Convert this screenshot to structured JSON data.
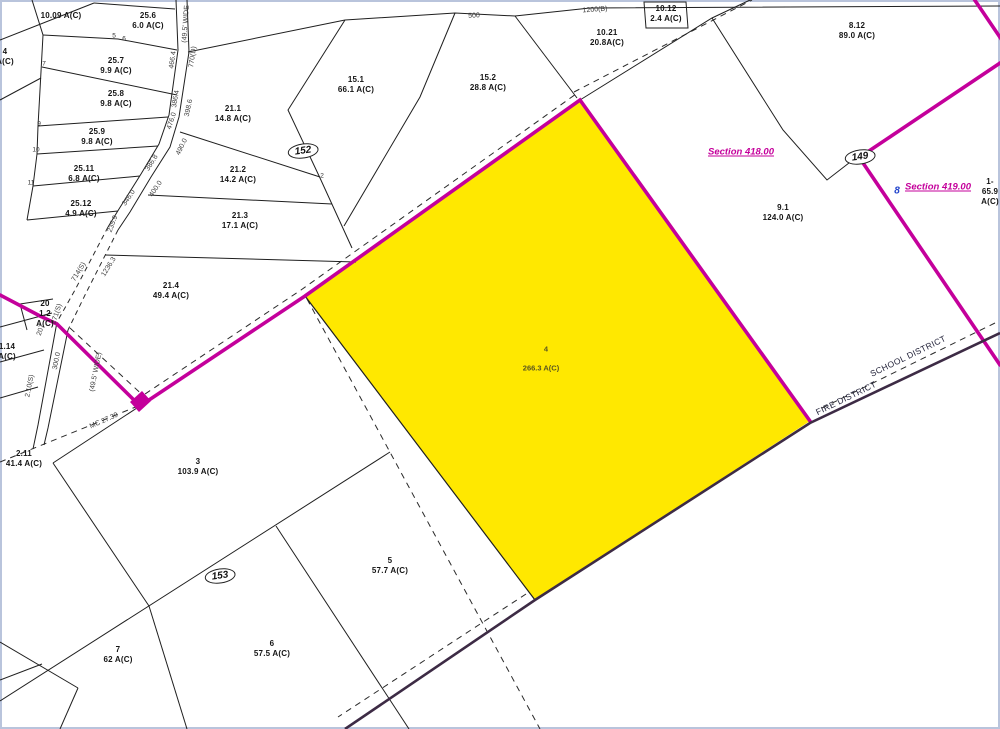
{
  "colors": {
    "highlight_fill": "#FFE800",
    "magenta": "#C4009B",
    "district_line": "#3D2B45",
    "section_text": "#CC0099",
    "blue_marker": "#2244CC",
    "frame_border": "#B9C4DC"
  },
  "highlight": {
    "num": "4",
    "area": "266.3 A(C)"
  },
  "parcels": [
    {
      "num": "",
      "area": "10.09 A(C)",
      "x": 61,
      "y": 16
    },
    {
      "num": "25.6",
      "area": "6.0 A(C)",
      "x": 148,
      "y": 21
    },
    {
      "num": "25.7",
      "area": "9.9 A(C)",
      "x": 116,
      "y": 66
    },
    {
      "num": "25.8",
      "area": "9.8 A(C)",
      "x": 116,
      "y": 99
    },
    {
      "num": "25.9",
      "area": "9.8 A(C)",
      "x": 97,
      "y": 137
    },
    {
      "num": "25.11",
      "area": "6.8 A(C)",
      "x": 84,
      "y": 174
    },
    {
      "num": "25.12",
      "area": "4.9 A(C)",
      "x": 81,
      "y": 209
    },
    {
      "num": "21.1",
      "area": "14.8 A(C)",
      "x": 233,
      "y": 114
    },
    {
      "num": "21.2",
      "area": "14.2 A(C)",
      "x": 238,
      "y": 175
    },
    {
      "num": "21.3",
      "area": "17.1 A(C)",
      "x": 240,
      "y": 221
    },
    {
      "num": "21.4",
      "area": "49.4 A(C)",
      "x": 171,
      "y": 291
    },
    {
      "num": "20",
      "area": "1.2\nA(C)",
      "x": 45,
      "y": 314
    },
    {
      "num": "1.14",
      "area": "A(C)",
      "x": 7,
      "y": 352
    },
    {
      "num": "4",
      "area": "A(C)",
      "x": 5,
      "y": 57
    },
    {
      "num": "2.11",
      "area": "41.4 A(C)",
      "x": 24,
      "y": 459
    },
    {
      "num": "15.1",
      "area": "66.1 A(C)",
      "x": 356,
      "y": 85
    },
    {
      "num": "15.2",
      "area": "28.8 A(C)",
      "x": 488,
      "y": 83
    },
    {
      "num": "10.21",
      "area": "20.8A(C)",
      "x": 607,
      "y": 38
    },
    {
      "num": "10.12",
      "area": "2.4 A(C)",
      "x": 666,
      "y": 14
    },
    {
      "num": "8.12",
      "area": "89.0 A(C)",
      "x": 857,
      "y": 31
    },
    {
      "num": "9.1",
      "area": "124.0 A(C)",
      "x": 783,
      "y": 213
    },
    {
      "num": "3",
      "area": "103.9 A(C)",
      "x": 198,
      "y": 467
    },
    {
      "num": "5",
      "area": "57.7 A(C)",
      "x": 390,
      "y": 566
    },
    {
      "num": "6",
      "area": "57.5 A(C)",
      "x": 272,
      "y": 649
    },
    {
      "num": "7",
      "area": "62 A(C)",
      "x": 118,
      "y": 655
    },
    {
      "num": "1-",
      "area": "65.9 A(C)",
      "x": 990,
      "y": 192
    }
  ],
  "tiny_numbers": [
    {
      "t": "5",
      "x": 114,
      "y": 36
    },
    {
      "t": "6",
      "x": 124,
      "y": 39
    },
    {
      "t": "7",
      "x": 44,
      "y": 64
    },
    {
      "t": "9",
      "x": 39,
      "y": 124
    },
    {
      "t": "10",
      "x": 36,
      "y": 150
    },
    {
      "t": "11",
      "x": 31,
      "y": 183
    },
    {
      "t": "2",
      "x": 322,
      "y": 176
    }
  ],
  "dims": [
    {
      "t": "(49.5' WIDE",
      "x": 186,
      "y": 24,
      "r": -86
    },
    {
      "t": "466.4",
      "x": 173,
      "y": 60,
      "r": -82
    },
    {
      "t": "770(D)",
      "x": 193,
      "y": 57,
      "r": -82
    },
    {
      "t": "386.4",
      "x": 176,
      "y": 99,
      "r": -80
    },
    {
      "t": "398.6",
      "x": 189,
      "y": 108,
      "r": -78
    },
    {
      "t": "476.0",
      "x": 172,
      "y": 121,
      "r": -72
    },
    {
      "t": "490.0",
      "x": 182,
      "y": 147,
      "r": -64
    },
    {
      "t": "386.8",
      "x": 152,
      "y": 163,
      "r": -58
    },
    {
      "t": "400.0",
      "x": 156,
      "y": 189,
      "r": -56
    },
    {
      "t": "346.0",
      "x": 129,
      "y": 198,
      "r": -56
    },
    {
      "t": "235.9",
      "x": 113,
      "y": 224,
      "r": -70
    },
    {
      "t": "714(S)",
      "x": 79,
      "y": 272,
      "r": -58
    },
    {
      "t": "1236.3",
      "x": 109,
      "y": 267,
      "r": -58
    },
    {
      "t": "271(S)",
      "x": 57,
      "y": 314,
      "r": -72
    },
    {
      "t": "207",
      "x": 41,
      "y": 330,
      "r": -72
    },
    {
      "t": "300.0",
      "x": 57,
      "y": 361,
      "r": -79
    },
    {
      "t": "(49.5' WIDE)",
      "x": 96,
      "y": 372,
      "r": -79
    },
    {
      "t": "2.10(S)",
      "x": 30,
      "y": 386,
      "r": -79
    },
    {
      "t": "MC 27.39",
      "x": 104,
      "y": 421,
      "r": -24
    },
    {
      "t": "500",
      "x": 474,
      "y": 16,
      "r": -2
    },
    {
      "t": "1200(B)",
      "x": 595,
      "y": 10,
      "r": -4
    }
  ],
  "sections": [
    {
      "t": "Section 418.00",
      "x": 741,
      "y": 152
    },
    {
      "t": "Section 419.00",
      "x": 938,
      "y": 187
    }
  ],
  "districts": [
    {
      "t": "FIRE DISTRICT",
      "x": 846,
      "y": 398,
      "r": -26
    },
    {
      "t": "SCHOOL DISTRICT",
      "x": 908,
      "y": 356,
      "r": -26
    }
  ],
  "bubbles": [
    {
      "t": "152",
      "x": 303,
      "y": 151
    },
    {
      "t": "149",
      "x": 860,
      "y": 157
    },
    {
      "t": "153",
      "x": 220,
      "y": 576
    }
  ],
  "blue_marker": {
    "t": "8",
    "x": 897,
    "y": 191
  }
}
